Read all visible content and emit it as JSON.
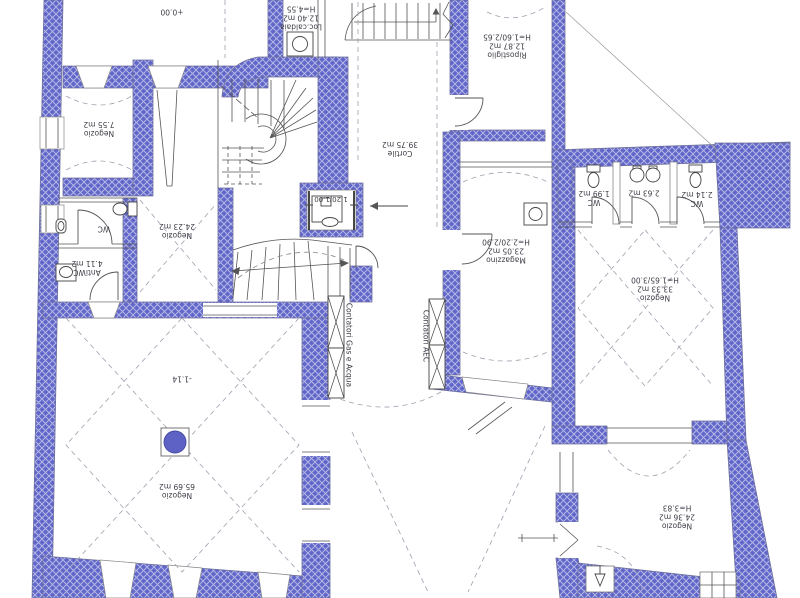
{
  "plan": {
    "annotations": {
      "level_upper": "+0.00",
      "level_lower": "-1.14",
      "elevator_size": "1.20/1.00"
    },
    "meters": {
      "gas_water": "Contatori Gas e Acqua",
      "electricity": "Contatori AEC"
    },
    "rooms": [
      {
        "name": "Loc.caldaia",
        "area": "12.40 m2",
        "height": "H=4.55"
      },
      {
        "name": "Negozio",
        "area": "7.55 m2"
      },
      {
        "name": "WC"
      },
      {
        "name": "AntiWC",
        "area": "4.11 m2"
      },
      {
        "name": "Negozio",
        "area": "24.23 m2"
      },
      {
        "name": "Cortile",
        "area": "39.75 m2"
      },
      {
        "name": "Ripostiglio",
        "area": "12.87 m2",
        "height": "H=1.60/2.65"
      },
      {
        "name": "Magazzino",
        "area": "23.05 m2",
        "height": "H=2.20/2.90"
      },
      {
        "name": "WC",
        "area": "1.99 m2"
      },
      {
        "name": "",
        "area": "2.63 m2"
      },
      {
        "name": "WC",
        "area": "2.14 m2"
      },
      {
        "name": "Negozio",
        "area": "33.33 m2",
        "height": "H=1.65/3.00"
      },
      {
        "name": "Negozio",
        "area": "24.36 m2",
        "height": "H=3.83"
      },
      {
        "name": "Negozio",
        "area": "65.69 m2"
      }
    ],
    "colors": {
      "wall_fill": "#6166c9",
      "wall_hatch": "#b4b7e6",
      "line": "#555555",
      "dash": "#a0a0b0"
    }
  }
}
